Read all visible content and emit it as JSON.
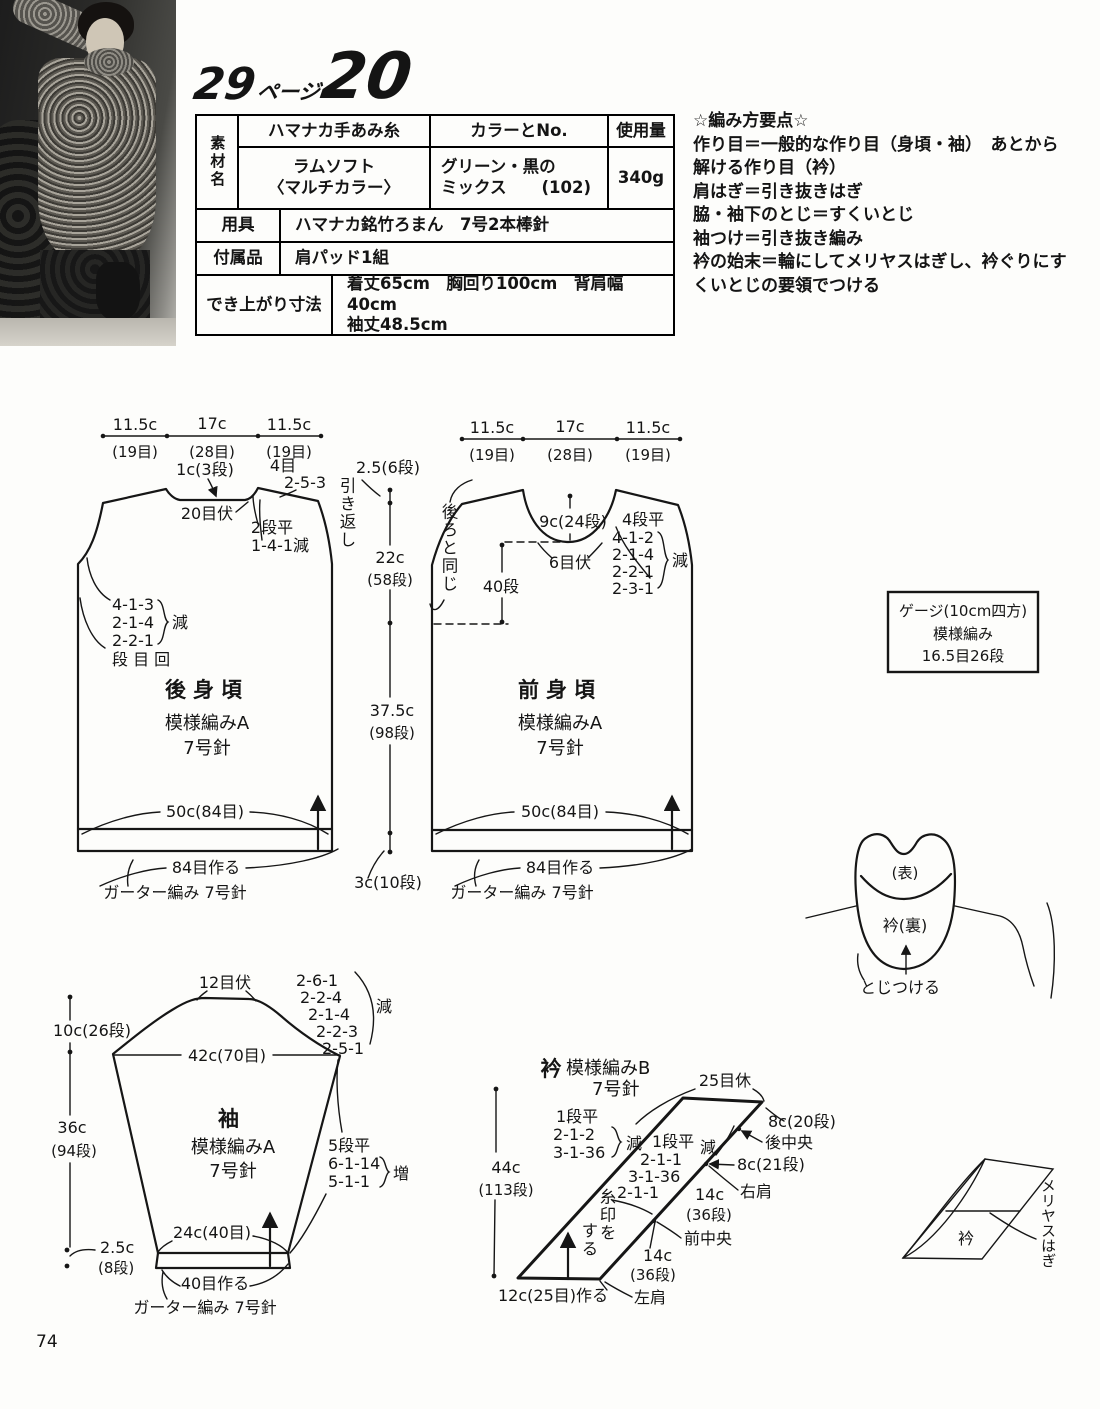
{
  "page_number": "74",
  "title": {
    "page": "29",
    "page_suffix": "ページ",
    "number": "20"
  },
  "table": {
    "corner": "素材名",
    "col_yarn": "ハマナカ手あみ糸",
    "col_color": "カラーとNo.",
    "col_use": "使用量",
    "yarn1": "ラムソフト",
    "yarn2": "〈マルチカラー〉",
    "color1": "グリーン・黒の",
    "color2": "ミックス",
    "color_no": "(102)",
    "use": "340g",
    "tools_label": "用具",
    "tools": "ハマナカ銘竹ろまん　7号2本棒針",
    "acc_label": "付属品",
    "acc": "肩パッド1組",
    "size_label": "でき上がり寸法",
    "size1": "着丈65cm　胸回り100cm　背肩幅40cm",
    "size2": "袖丈48.5cm"
  },
  "notes": {
    "title": "☆編み方要点☆",
    "lines": [
      "作り目＝一般的な作り目（身頃・袖）　あとから",
      "解ける作り目（衿）",
      "肩はぎ＝引き抜きはぎ",
      "脇・袖下のとじ＝すくいとじ",
      "袖つけ＝引き抜き編み",
      "衿の始末＝輪にしてメリヤスはぎし、衿ぐりにす",
      "くいとじの要領でつける"
    ]
  },
  "gauge": {
    "l1": "ゲージ(10cm四方)",
    "l2": "模様編み",
    "l3": "16.5目26段"
  },
  "back": {
    "w1": "11.5c",
    "w1s": "(19目)",
    "w2": "17c",
    "w2s": "(28目)",
    "w3": "11.5c",
    "w3s": "(19目)",
    "neck_depth": "1c(3段)",
    "neck_bo": "20目伏",
    "shoulder_sts": "4目",
    "shoulder_sr": "2-5-3",
    "turn": "引き返し",
    "neck_flat": "2段平",
    "neck_dec": "1-4-1減",
    "arm1": "4-1-3",
    "arm2": "2-1-4",
    "arm3": "2-2-1",
    "dec": "減",
    "legend": "段 目 回",
    "name": "後身頃",
    "pattern": "模様編みA",
    "needle": "7号針",
    "width": "50c(84目)",
    "caston": "84目作る",
    "garter": "ガーター編み 7号針"
  },
  "center": {
    "c1": "2.5(6段)",
    "c2": "22c",
    "c2s": "(58段)",
    "c3": "37.5c",
    "c3s": "(98段)",
    "c4": "3c(10段)"
  },
  "front": {
    "w1": "11.5c",
    "w1s": "(19目)",
    "w2": "17c",
    "w2s": "(28目)",
    "w3": "11.5c",
    "w3s": "(19目)",
    "same": "後ろと同じ",
    "rows40": "40段",
    "neck_depth": "9c(24段)",
    "neck_bo": "6目伏",
    "flat": "4段平",
    "d1": "4-1-2",
    "d2": "2-1-4",
    "d3": "2-2-1",
    "d4": "2-3-1",
    "dec": "減",
    "name": "前身頃",
    "pattern": "模様編みA",
    "needle": "7号針",
    "width": "50c(84目)",
    "caston": "84目作る",
    "garter": "ガーター編み 7号針"
  },
  "attach": {
    "omote": "(表)",
    "ura": "衿(裏)",
    "toji": "とじつける"
  },
  "sleeve": {
    "bo": "12目伏",
    "d1": "2-6-1",
    "d2": "2-2-4",
    "d3": "2-1-4",
    "d4": "2-2-3",
    "d5": "2-5-1",
    "dec": "減",
    "top": "42c(70目)",
    "m1": "10c(26段)",
    "m2": "36c",
    "m2s": "(94段)",
    "m3": "2.5c",
    "m3s": "(8段)",
    "name": "袖",
    "pattern": "模様編みA",
    "needle": "7号針",
    "flat": "5段平",
    "i1": "6-1-14",
    "i2": "5-1-1",
    "inc": "増",
    "cuff": "24c(40目)",
    "caston": "40目作る",
    "garter": "ガーター編み 7号針"
  },
  "collar": {
    "name": "衿",
    "pattern": "模様編みB",
    "needle": "7号針",
    "rest": "25目休",
    "o1": "1段平",
    "o2": "2-1-2",
    "o3": "3-1-36",
    "odec": "減",
    "n1": "1段平",
    "ndec": "減",
    "n2": "2-1-1",
    "n3": "3-1-36",
    "n4": "2-1-1",
    "mark_a": "糸印を",
    "mark_b": "する",
    "m": "44c",
    "ms": "(113段)",
    "s1": "8c(20段)",
    "p1": "後中央",
    "s2": "8c(21段)",
    "p2": "右肩",
    "s3": "14c",
    "s3s": "(36段)",
    "p3": "前中央",
    "s4": "14c",
    "s4s": "(36段)",
    "p4": "左肩",
    "caston": "12c(25目)作る"
  },
  "fold": {
    "name": "衿",
    "seam": "メリヤスはぎ"
  }
}
